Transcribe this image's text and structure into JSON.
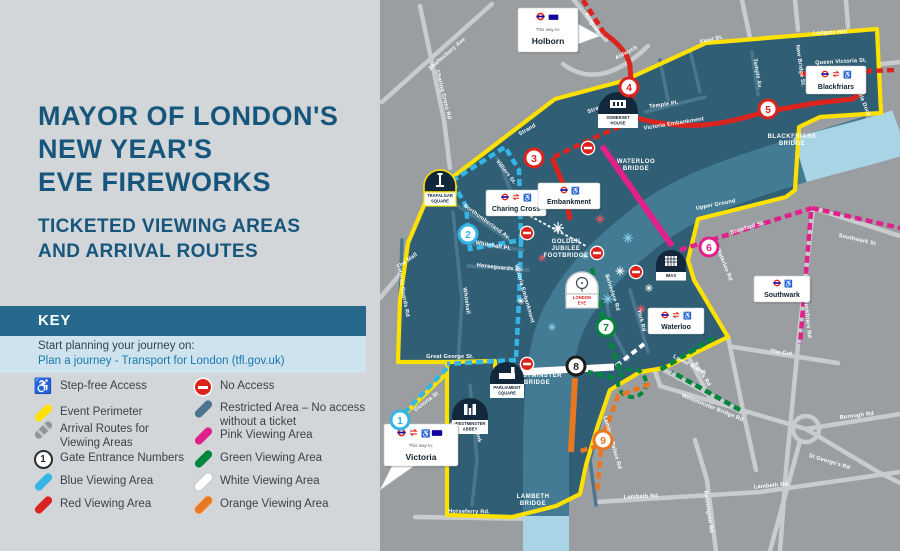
{
  "panel": {
    "title_lines": [
      "MAYOR OF LONDON'S",
      "NEW YEAR'S",
      "EVE FIREWORKS"
    ],
    "subtitle_lines": [
      "TICKETED VIEWING AREAS",
      "AND ARRIVAL ROUTES"
    ],
    "key_heading": "KEY",
    "plan_label": "Start planning your journey on:",
    "plan_link": "Plan a journey - Transport for London (tfl.gov.uk)",
    "legend_left": [
      {
        "icon": "wheelchair",
        "label": "Step-free Access",
        "top": 378
      },
      {
        "icon": "pill-yellow",
        "label": "Event Perimeter",
        "top": 404
      },
      {
        "icon": "pill-graydash",
        "label": "Arrival Routes for\nViewing Areas",
        "top": 421
      },
      {
        "icon": "gate",
        "label": "Gate Entrance Numbers",
        "top": 450
      },
      {
        "icon": "pill-blue",
        "label": "Blue Viewing Area",
        "top": 473
      },
      {
        "icon": "pill-red",
        "label": "Red Viewing Area",
        "top": 496
      }
    ],
    "legend_right": [
      {
        "icon": "noaccess",
        "label": "No Access",
        "top": 378
      },
      {
        "icon": "pill-steel",
        "label": "Restricted Area – No access\nwithout a ticket",
        "top": 400
      },
      {
        "icon": "pill-pink",
        "label": "Pink Viewing Area",
        "top": 427
      },
      {
        "icon": "pill-green",
        "label": "Green Viewing Area",
        "top": 450
      },
      {
        "icon": "pill-white",
        "label": "White Viewing Area",
        "top": 473
      },
      {
        "icon": "pill-orange",
        "label": "Orange Viewing Area",
        "top": 496
      }
    ]
  },
  "map": {
    "callouts": {
      "holborn": {
        "prefix": "This way to:",
        "name": "Holborn"
      },
      "victoria": {
        "prefix": "This way to:",
        "name": "Victoria"
      }
    },
    "stations": {
      "charing_cross": "Charing Cross",
      "embankment": "Embankment",
      "blackfriars": "Blackfriars",
      "waterloo": "Waterloo",
      "southwark": "Southwark"
    },
    "landmarks": [
      {
        "id": "trafalgar-square",
        "x": 424,
        "y": 170,
        "w": 32,
        "lines": [
          "TRAFALGAR",
          "SQUARE"
        ],
        "icon": "column",
        "variant": "yellow"
      },
      {
        "id": "somerset-house",
        "x": 598,
        "y": 92,
        "w": 40,
        "lines": [
          "SOMERSET",
          "HOUSE"
        ],
        "icon": "building",
        "variant": "dark"
      },
      {
        "id": "imax",
        "x": 656,
        "y": 250,
        "w": 30,
        "lines": [
          "IMAX"
        ],
        "icon": "grid",
        "variant": "dark"
      },
      {
        "id": "london-eye",
        "x": 566,
        "y": 272,
        "w": 32,
        "lines": [
          "LONDON",
          "EYE"
        ],
        "icon": "eye",
        "variant": "white"
      },
      {
        "id": "westminster-abbey",
        "x": 452,
        "y": 398,
        "w": 36,
        "lines": [
          "WESTMINSTER",
          "ABBEY"
        ],
        "icon": "abbey",
        "variant": "dark"
      },
      {
        "id": "parliament-square",
        "x": 490,
        "y": 362,
        "w": 34,
        "lines": [
          "PARLIAMENT",
          "SQUARE"
        ],
        "icon": "parliament",
        "variant": "dark"
      }
    ],
    "bridges": [
      {
        "lines": [
          "WATERLOO",
          "BRIDGE"
        ],
        "x": 636,
        "y": 163
      },
      {
        "lines": [
          "BLACKFRIARS",
          "BRIDGE"
        ],
        "x": 792,
        "y": 138
      },
      {
        "lines": [
          "WESTMINSTER",
          "BRIDGE"
        ],
        "x": 537,
        "y": 377
      },
      {
        "lines": [
          "LAMBETH",
          "BRIDGE"
        ],
        "x": 533,
        "y": 498
      },
      {
        "lines": [
          "GOLDEN",
          "JUBILEE",
          "FOOTBRIDGE"
        ],
        "x": 566,
        "y": 243
      }
    ],
    "gates": [
      {
        "n": "1",
        "x": 400,
        "y": 420,
        "c": "blue"
      },
      {
        "n": "2",
        "x": 468,
        "y": 234,
        "c": "blue"
      },
      {
        "n": "3",
        "x": 534,
        "y": 158,
        "c": "red"
      },
      {
        "n": "4",
        "x": 629,
        "y": 87,
        "c": "red"
      },
      {
        "n": "5",
        "x": 768,
        "y": 109,
        "c": "red"
      },
      {
        "n": "6",
        "x": 709,
        "y": 247,
        "c": "pink"
      },
      {
        "n": "7",
        "x": 606,
        "y": 327,
        "c": "green"
      },
      {
        "n": "8",
        "x": 576,
        "y": 366,
        "c": "dark"
      },
      {
        "n": "9",
        "x": 603,
        "y": 440,
        "c": "orange"
      }
    ],
    "no_access": [
      [
        588,
        148
      ],
      [
        527,
        233
      ],
      [
        597,
        253
      ],
      [
        636,
        272
      ],
      [
        527,
        364
      ]
    ],
    "fireworks": [
      [
        558,
        228,
        "w",
        1.2
      ],
      [
        600,
        219,
        "r",
        0.9
      ],
      [
        628,
        238,
        "b",
        1.0
      ],
      [
        542,
        258,
        "r",
        0.8
      ],
      [
        570,
        297,
        "w",
        1.0
      ],
      [
        608,
        299,
        "b",
        1.1
      ],
      [
        641,
        309,
        "r",
        0.9
      ],
      [
        552,
        327,
        "b",
        0.8
      ],
      [
        521,
        301,
        "w",
        0.7
      ],
      [
        649,
        288,
        "w",
        0.8
      ],
      [
        585,
        256,
        "b",
        0.7
      ],
      [
        620,
        271,
        "w",
        0.9
      ]
    ],
    "streets": [
      [
        "Shaftesbury Ave",
        448,
        55,
        -41
      ],
      [
        "Charing Cross Rd",
        442,
        95,
        76
      ],
      [
        "The Mall",
        408,
        262,
        -36
      ],
      [
        "Strand",
        528,
        131,
        -30
      ],
      [
        "Strand",
        597,
        110,
        -22
      ],
      [
        "Villiers St.",
        505,
        173,
        52
      ],
      [
        "Northumberland Av.",
        486,
        223,
        36
      ],
      [
        "Whitehall Pl.",
        493,
        247,
        10
      ],
      [
        "Horseguards Av.",
        500,
        269,
        6
      ],
      [
        "Whitehall",
        465,
        301,
        82
      ],
      [
        "Horse Guards Rd",
        402,
        293,
        80
      ],
      [
        "Victoria Embankment",
        523,
        294,
        74
      ],
      [
        "Great George St.",
        450,
        358,
        0
      ],
      [
        "Victoria St",
        427,
        403,
        -37
      ],
      [
        "Great Smith St.",
        452,
        444,
        84
      ],
      [
        "Millbank",
        476,
        431,
        80
      ],
      [
        "Horseferry Rd.",
        469,
        513,
        1
      ],
      [
        "Temple Pl.",
        664,
        106,
        -8
      ],
      [
        "Temple Av.",
        756,
        74,
        80
      ],
      [
        "Fleet St.",
        712,
        41,
        -14
      ],
      [
        "Ludgate Hill",
        830,
        34,
        -2
      ],
      [
        "New Bridge St.",
        799,
        66,
        82
      ],
      [
        "Queen Victoria St.",
        841,
        63,
        -3
      ],
      [
        "Puddle Dock",
        861,
        100,
        68
      ],
      [
        "Victoria Embankment",
        674,
        125,
        -9
      ],
      [
        "Upper Ground",
        716,
        206,
        -11
      ],
      [
        "Stamford St.",
        748,
        229,
        -17
      ],
      [
        "Southwark St",
        857,
        241,
        13
      ],
      [
        "Blackfriars Rd",
        806,
        318,
        84
      ],
      [
        "The Cut",
        781,
        354,
        7
      ],
      [
        "Borough Rd",
        857,
        417,
        -7
      ],
      [
        "St George's Rd",
        829,
        463,
        17
      ],
      [
        "Westminster Bridge Rd",
        712,
        409,
        22
      ],
      [
        "Baylis Rd",
        701,
        375,
        58
      ],
      [
        "Lower Marsh",
        689,
        366,
        28
      ],
      [
        "Kennington Rd",
        707,
        512,
        82
      ],
      [
        "Lambeth Rd",
        641,
        498,
        -2
      ],
      [
        "Lambeth Rd.",
        772,
        487,
        -5
      ],
      [
        "Lambeth Palace Rd",
        611,
        443,
        74
      ],
      [
        "York Rd",
        640,
        321,
        76
      ],
      [
        "Waterloo Rd",
        723,
        265,
        68
      ],
      [
        "Belvedere Rd",
        611,
        293,
        72
      ],
      [
        "Kingsway",
        592,
        26,
        58
      ],
      [
        "Aldwych",
        627,
        54,
        -28
      ]
    ]
  },
  "colors": {
    "blue": "#35b5e5",
    "red": "#dc241f",
    "pink": "#e0218a",
    "green": "#00863c",
    "orange": "#e87722",
    "dark": "#1d1d1b",
    "yellow": "#ffe100",
    "zone": "#305e75",
    "river_in": "#427b93",
    "river_out": "#a9d4e6",
    "fw_w": "#ffffff",
    "fw_r": "#f05a66",
    "fw_b": "#86d3ec"
  }
}
